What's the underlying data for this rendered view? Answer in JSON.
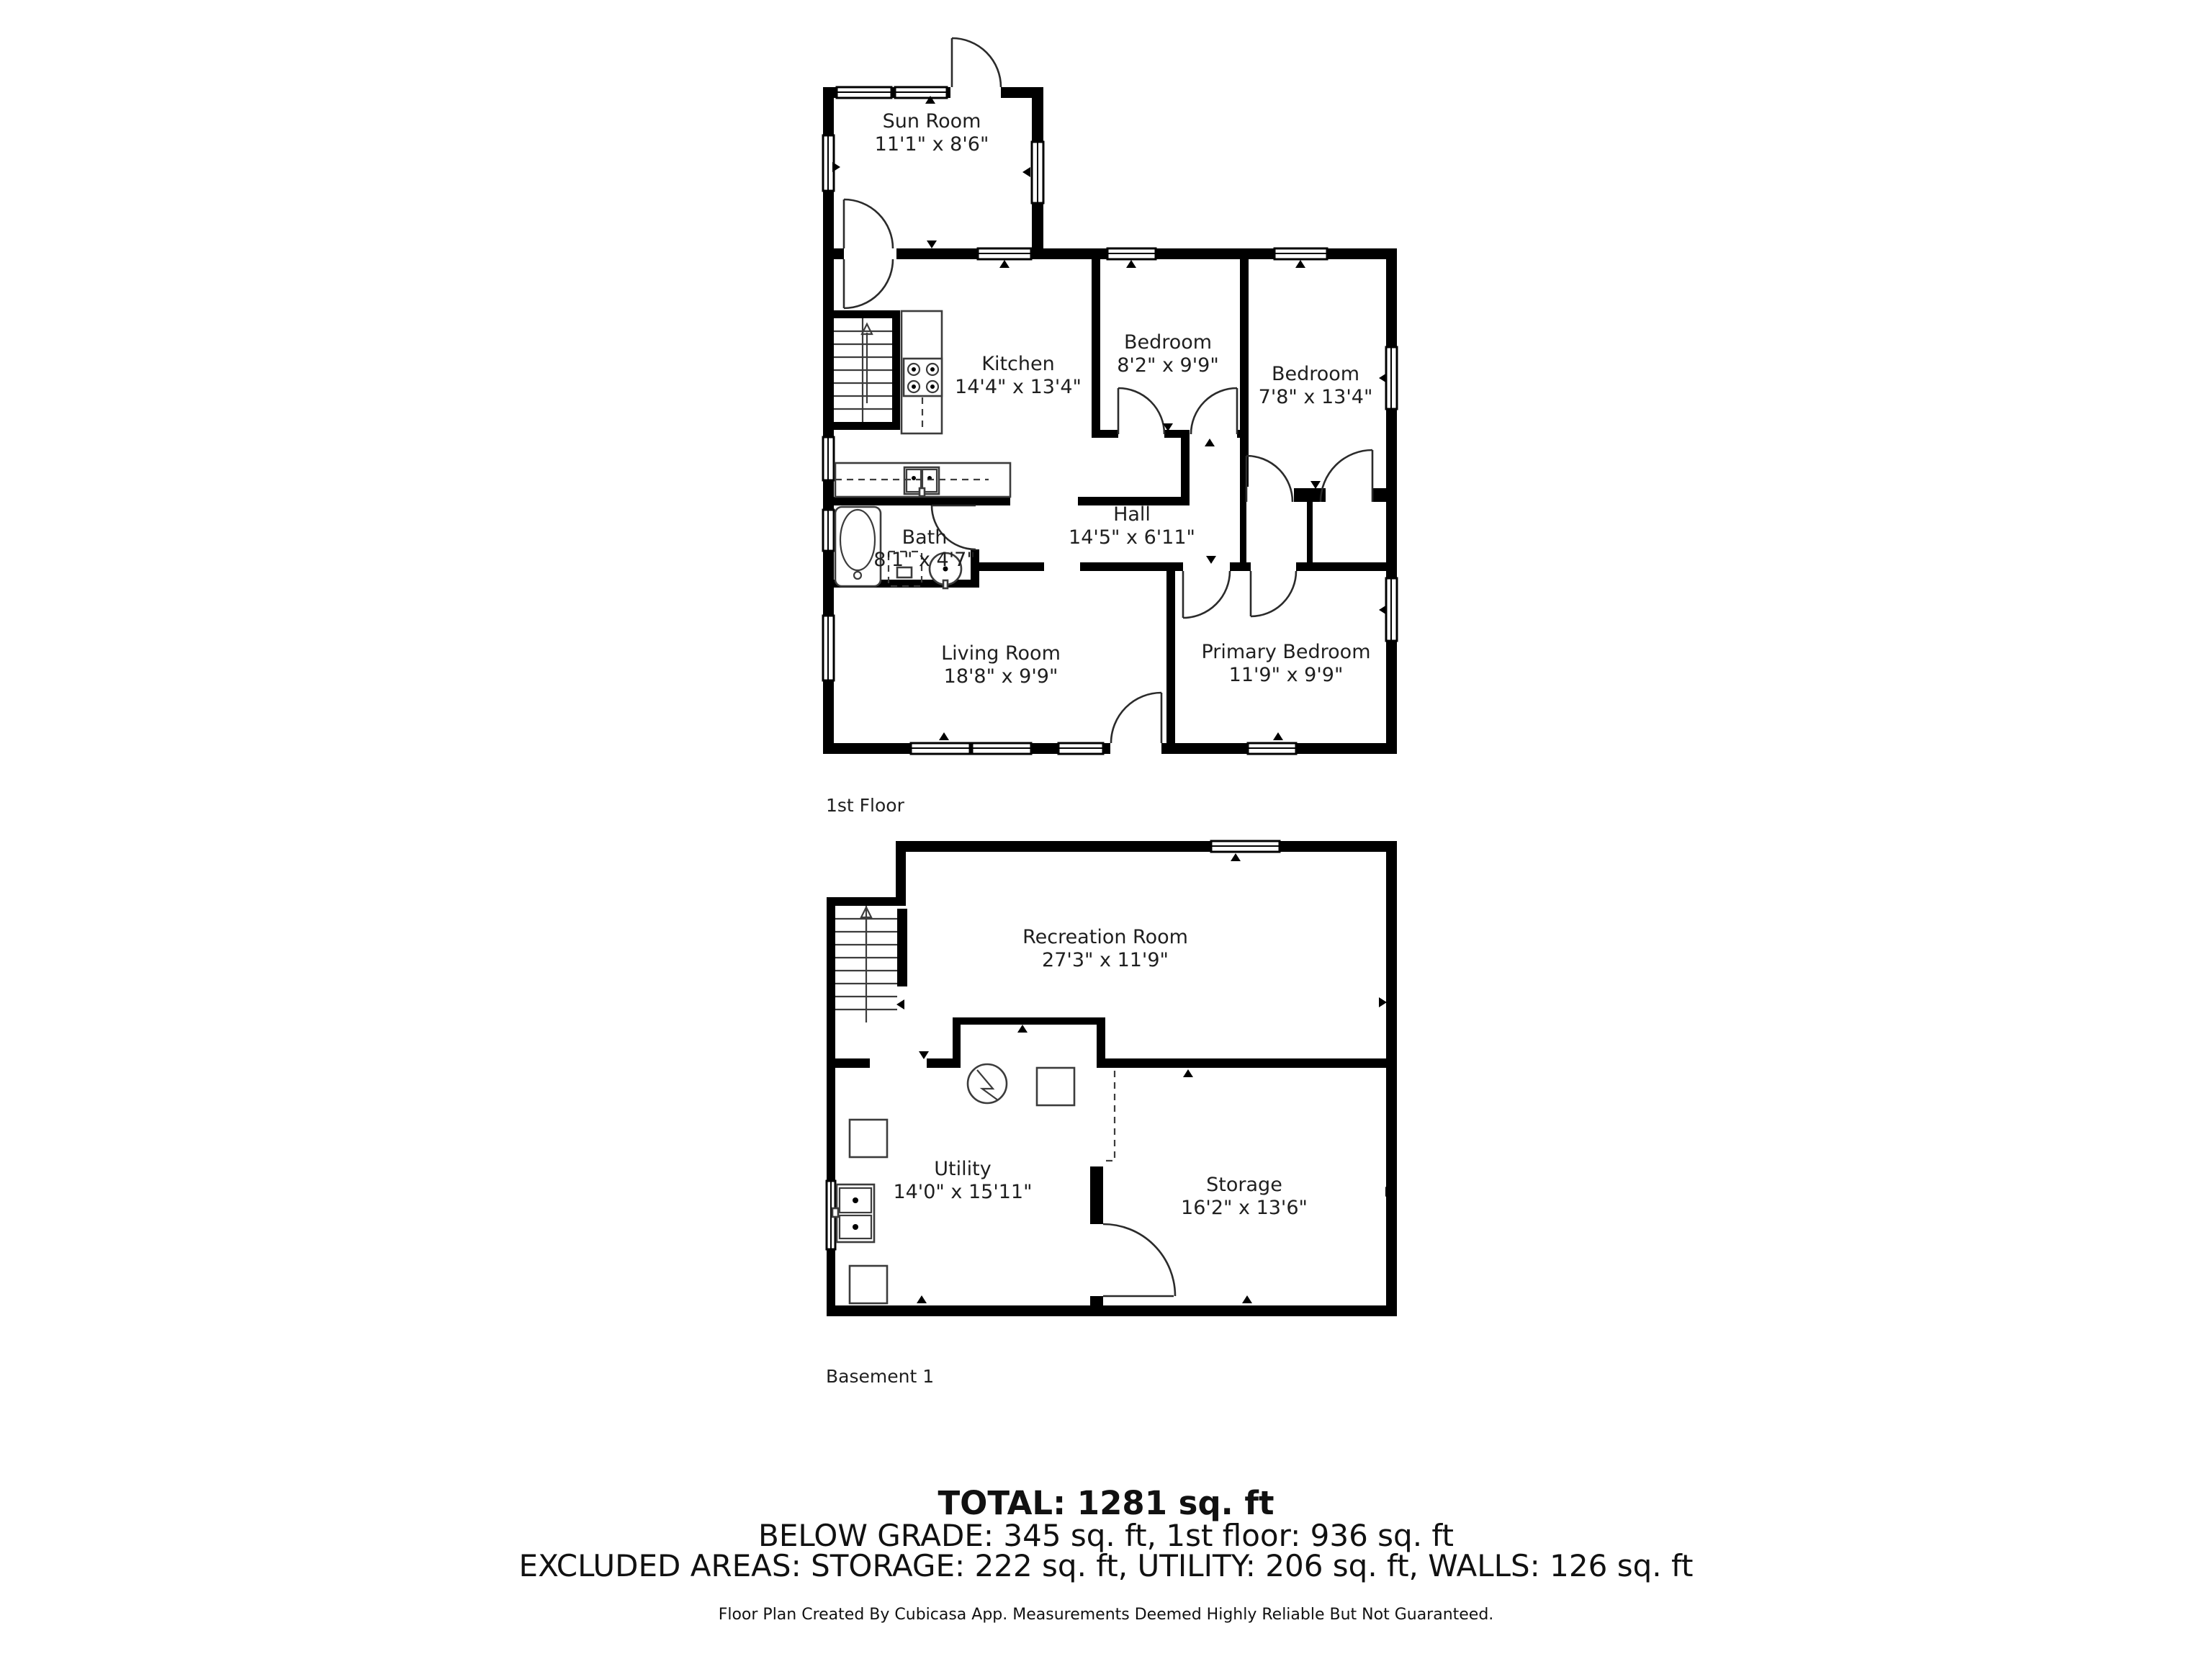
{
  "page": {
    "background": "#ffffff",
    "wall_color": "#000000",
    "text_color": "#1f1f1f"
  },
  "floors": [
    {
      "label": "1st Floor",
      "rooms": [
        {
          "name": "Sun Room",
          "dims": "11'1\" x 8'6\""
        },
        {
          "name": "Kitchen",
          "dims": "14'4\" x 13'4\""
        },
        {
          "name": "Bedroom",
          "dims": "8'2\" x 9'9\""
        },
        {
          "name": "Bedroom",
          "dims": "7'8\" x 13'4\""
        },
        {
          "name": "Hall",
          "dims": "14'5\" x 6'11\""
        },
        {
          "name": "Bath",
          "dims": "8'1\" x 4'7\""
        },
        {
          "name": "Living Room",
          "dims": "18'8\" x 9'9\""
        },
        {
          "name": "Primary Bedroom",
          "dims": "11'9\" x 9'9\""
        }
      ]
    },
    {
      "label": "Basement 1",
      "rooms": [
        {
          "name": "Recreation Room",
          "dims": "27'3\" x 11'9\""
        },
        {
          "name": "Utility",
          "dims": "14'0\" x 15'11\""
        },
        {
          "name": "Storage",
          "dims": "16'2\" x 13'6\""
        }
      ]
    }
  ],
  "summary": {
    "total": "TOTAL: 1281 sq. ft",
    "grade_line": "BELOW GRADE: 345 sq. ft, 1st floor: 936 sq. ft",
    "excluded_line": "EXCLUDED AREAS: STORAGE: 222 sq. ft, UTILITY: 206 sq. ft, WALLS: 126 sq. ft",
    "disclaimer": "Floor Plan Created By Cubicasa App. Measurements Deemed Highly Reliable But Not Guaranteed."
  }
}
